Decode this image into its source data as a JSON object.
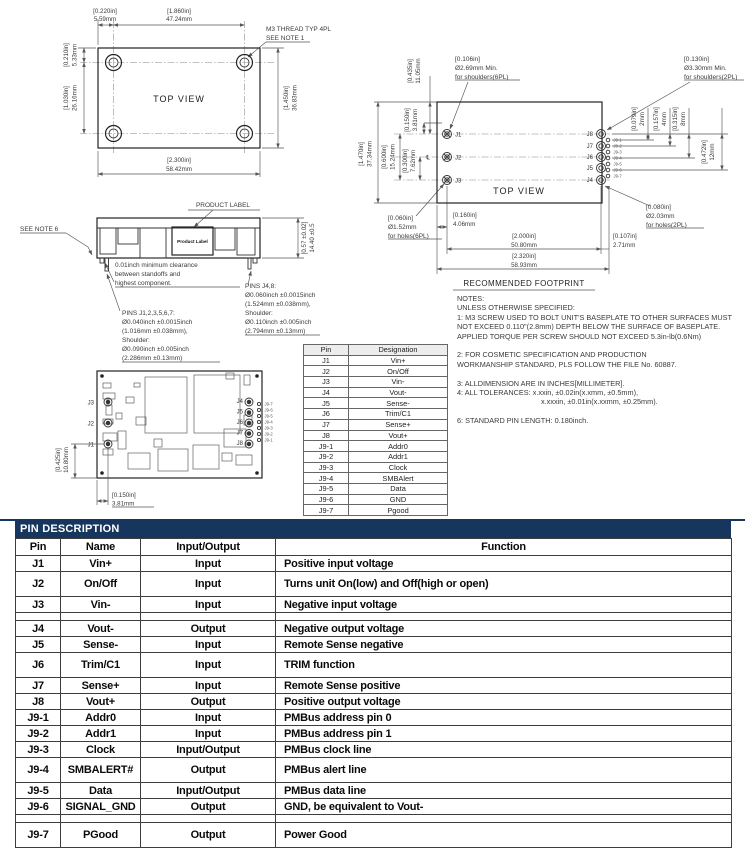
{
  "top_view": {
    "title": "TOP VIEW",
    "thread_callout": [
      "M3 THREAD TYP 4PL",
      "SEE NOTE 1"
    ],
    "d1_in": "[0.220in]",
    "d1_mm": "5.59mm",
    "d2_in": "[1.860in]",
    "d2_mm": "47.24mm",
    "d3_in": "[0.210in]",
    "d3_mm": "5.33mm",
    "d4_in": "[1.030in]",
    "d4_mm": "26.16mm",
    "d5_in": "[1.450in]",
    "d5_mm": "36.83mm",
    "d6_in": "[2.300in]",
    "d6_mm": "58.42mm"
  },
  "side_view": {
    "callout": "PRODUCT LABEL",
    "label": "Product Label",
    "see_note": "SEE NOTE 6",
    "d_in": "[0.57 ±0.02]",
    "d_mm": "14.40 ±0.5",
    "clearance": [
      "0.01inch minimum clearance",
      "between standoffs and",
      "highest component."
    ],
    "pins_small": [
      "PINS J1,2,3,5,6,7:",
      "Ø0.040inch ±0.0015inch",
      "(1.016mm ±0.038mm),",
      "Shoulder:",
      "Ø0.090inch ±0.005inch",
      "(2.286mm ±0.13mm)"
    ],
    "pins_large": [
      "PINS J4,8:",
      "Ø0.060inch ±0.0015inch",
      "(1.524mm ±0.038mm),",
      "Shoulder:",
      "Ø0.110inch ±0.005inch",
      "(2.794mm ±0.13mm)"
    ]
  },
  "footprint": {
    "title": "TOP VIEW",
    "caption": "RECOMMENDED FOOTPRINT",
    "cl": "℄",
    "c_sh6": [
      "[0.106in]",
      "Ø2.69mm Min.",
      "for shoulders(6PL)"
    ],
    "c_sh2": [
      "[0.130in]",
      "Ø3.30mm Min.",
      "for shoulders(2PL)"
    ],
    "c_h6": [
      "[0.060in]",
      "Ø1.52mm",
      "for holes(6PL)"
    ],
    "c_h2": [
      "[0.080in]",
      "Ø2.03mm",
      "for holes(2PL)"
    ],
    "d_1470_in": "[1.470in]",
    "d_1470_mm": "37.34mm",
    "d_0600_in": "[0.600in]",
    "d_0600_mm": "15.24mm",
    "d_0300_in": "[0.300in]",
    "d_0300_mm": "7.62mm",
    "d_0150_in": "[0.150in]",
    "d_0150_mm": "3.81mm",
    "d_0435_in": "[0.435in]",
    "d_0435_mm": "11.05mm",
    "d_0079_in": "[0.079in]",
    "d_0079_mm": "2mm",
    "d_0157_in": "[0.157in]",
    "d_0157_mm": "4mm",
    "d_0315_in": "[0.315in]",
    "d_0315_mm": "8mm",
    "d_0472_in": "[0.472in]",
    "d_0472_mm": "12mm",
    "d_0160_in": "[0.160in]",
    "d_0160_mm": "4.06mm",
    "d_2000_in": "[2.000in]",
    "d_2000_mm": "50.80mm",
    "d_2320_in": "[2.320in]",
    "d_2320_mm": "58.93mm",
    "d_0107_in": "[0.107in]",
    "d_0107_mm": "2.71mm",
    "pins_left": [
      "J1",
      "J2",
      "J3"
    ],
    "pins_right": [
      "J8",
      "J7",
      "J6",
      "J5",
      "J4"
    ],
    "pins_small": [
      "J9-1",
      "J9-2",
      "J9-3",
      "J9-4",
      "J9-5",
      "J9-6",
      "J9-7"
    ]
  },
  "pcb_view": {
    "pins_left": [
      "J3",
      "J2",
      "J1"
    ],
    "pins_right": [
      "J4",
      "J5",
      "J6",
      "J7",
      "J8"
    ],
    "pins_small": [
      "J9-7",
      "J9-6",
      "J9-5",
      "J9-4",
      "J9-3",
      "J9-2",
      "J9-1"
    ],
    "d_0425_in": "[0.425in]",
    "d_0425_mm": "10.80mm",
    "d_0150_in": "[0.150in]",
    "d_0150_mm": "3.81mm"
  },
  "notes": {
    "lines": [
      "NOTES:",
      "UNLESS OTHERWISE SPECIFIED:",
      "1: M3 SCREW USED TO BOLT UNIT'S BASEPLATE TO OTHER SURFACES MUST",
      "NOT EXCEED 0.110\"(2.8mm) DEPTH BELOW THE SURFACE OF BASEPLATE.",
      "APPLIED TORQUE PER SCREW SHOULD NOT EXCEED 5.3in-lb(0.6Nm)",
      "",
      "2: FOR COSMETIC SPECIFICATION AND PRODUCTION",
      "WORKMANSHIP STANDARD, PLS FOLLOW THE FILE No. 60887.",
      "",
      "3: ALLDIMENSION ARE IN INCHES[MILLIMETER].",
      "4: ALL TOLERANCES: x.xxin, ±0.02in(x.xmm, ±0.5mm),",
      "x.xxxin, ±0.01in(x.xxmm, ±0.25mm).",
      "",
      "6: STANDARD PIN LENGTH: 0.180inch."
    ]
  },
  "pin_table": {
    "headers": [
      "Pin",
      "Designation"
    ],
    "rows": [
      [
        "J1",
        "Vin+"
      ],
      [
        "J2",
        "On/Off"
      ],
      [
        "J3",
        "Vin-"
      ],
      [
        "J4",
        "Vout-"
      ],
      [
        "J5",
        "Sense-"
      ],
      [
        "J6",
        "Trim/C1"
      ],
      [
        "J7",
        "Sense+"
      ],
      [
        "J8",
        "Vout+"
      ],
      [
        "J9-1",
        "Addr0"
      ],
      [
        "J9-2",
        "Addr1"
      ],
      [
        "J9-3",
        "Clock"
      ],
      [
        "J9-4",
        "SMBAlert"
      ],
      [
        "J9-5",
        "Data"
      ],
      [
        "J9-6",
        "GND"
      ],
      [
        "J9-7",
        "Pgood"
      ]
    ]
  },
  "pin_description": {
    "title": "PIN DESCRIPTION",
    "headers": [
      "Pin",
      "Name",
      "Input/Output",
      "Function"
    ],
    "colors": {
      "title_bg": "#17365d",
      "title_fg": "#ffffff"
    },
    "rows": [
      {
        "pin": "J1",
        "name": "Vin+",
        "io": "Input",
        "fn": "Positive input voltage"
      },
      {
        "pin": "J2",
        "name": "On/Off",
        "io": "Input",
        "fn": "Turns unit On(low) and Off(high or open)"
      },
      {
        "pin": "J3",
        "name": "Vin-",
        "io": "Input",
        "fn": "Negative input voltage"
      },
      {
        "pin": "J4",
        "name": "Vout-",
        "io": "Output",
        "fn": "Negative output voltage"
      },
      {
        "pin": "J5",
        "name": "Sense-",
        "io": "Input",
        "fn": "Remote Sense negative"
      },
      {
        "pin": "J6",
        "name": "Trim/C1",
        "io": "Input",
        "fn": "TRIM function"
      },
      {
        "pin": "J7",
        "name": "Sense+",
        "io": "Input",
        "fn": "Remote Sense positive"
      },
      {
        "pin": "J8",
        "name": "Vout+",
        "io": "Output",
        "fn": "Positive output voltage"
      },
      {
        "pin": "J9-1",
        "name": "Addr0",
        "io": "Input",
        "fn": "PMBus address pin 0"
      },
      {
        "pin": "J9-2",
        "name": "Addr1",
        "io": "Input",
        "fn": "PMBus address pin 1"
      },
      {
        "pin": "J9-3",
        "name": "Clock",
        "io": "Input/Output",
        "fn": "PMBus clock line"
      },
      {
        "pin": "J9-4",
        "name": "SMBALERT#",
        "io": "Output",
        "fn": "PMBus alert line"
      },
      {
        "pin": "J9-5",
        "name": "Data",
        "io": "Input/Output",
        "fn": "PMBus data line"
      },
      {
        "pin": "J9-6",
        "name": "SIGNAL_GND",
        "io": "Output",
        "fn": "GND, be equivalent to Vout-"
      },
      {
        "pin": "J9-7",
        "name": "PGood",
        "io": "Output",
        "fn": "Power Good"
      }
    ]
  }
}
